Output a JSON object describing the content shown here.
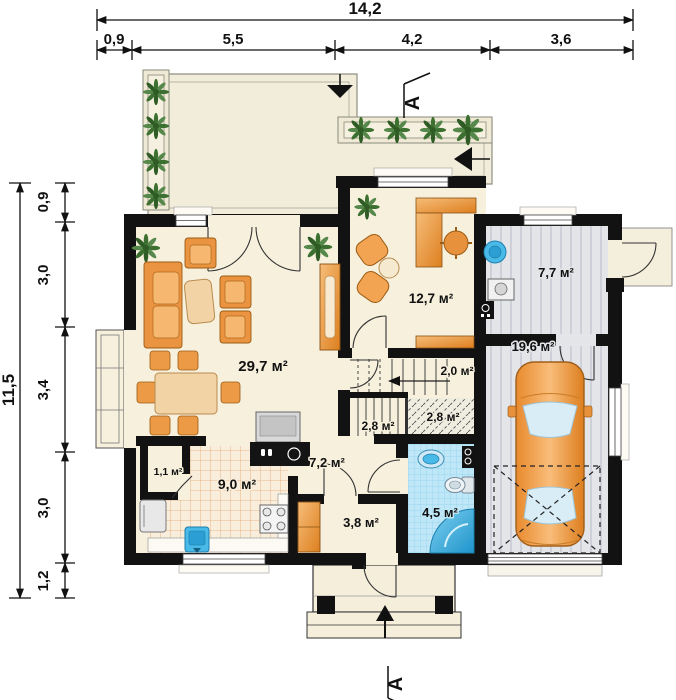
{
  "dimensions": {
    "top": {
      "total": "14,2",
      "segments": [
        "0,9",
        "5,5",
        "4,2",
        "3,6"
      ]
    },
    "left": {
      "total": "11,5",
      "segments": [
        "0,9",
        "3,0",
        "3,4",
        "3,0",
        "1,2"
      ]
    }
  },
  "section": {
    "label": "A"
  },
  "rooms": {
    "living_room": {
      "area": "29,7 м²"
    },
    "study": {
      "area": "12,7 м²"
    },
    "utility": {
      "area": "7,7 м²"
    },
    "garage": {
      "area": "19,6 м²"
    },
    "stairs_upper": {
      "area": "2,0 м²"
    },
    "stairs_lower_left": {
      "area": "2,8 м²"
    },
    "stairs_lower_right": {
      "area": "2,8 м²"
    },
    "hall": {
      "area": "7,2 м²"
    },
    "kitchen": {
      "area": "9,0 м²"
    },
    "pantry": {
      "area": "1,1 м²"
    },
    "vestibule": {
      "area": "3,8 м²"
    },
    "bathroom": {
      "area": "4,5 м²"
    }
  },
  "colors": {
    "wall": "#121212",
    "floor_cream": "#f6f0dd",
    "terrace": "#f2edda",
    "garage_floor": "#e4e5e9",
    "bath_tile": "#bfe7f7",
    "kitchen_tile": "#f9eedb",
    "wood_accent": "#ec9a46",
    "fixture_blue": "#49b9e8",
    "plant_green": "#3c7030"
  }
}
